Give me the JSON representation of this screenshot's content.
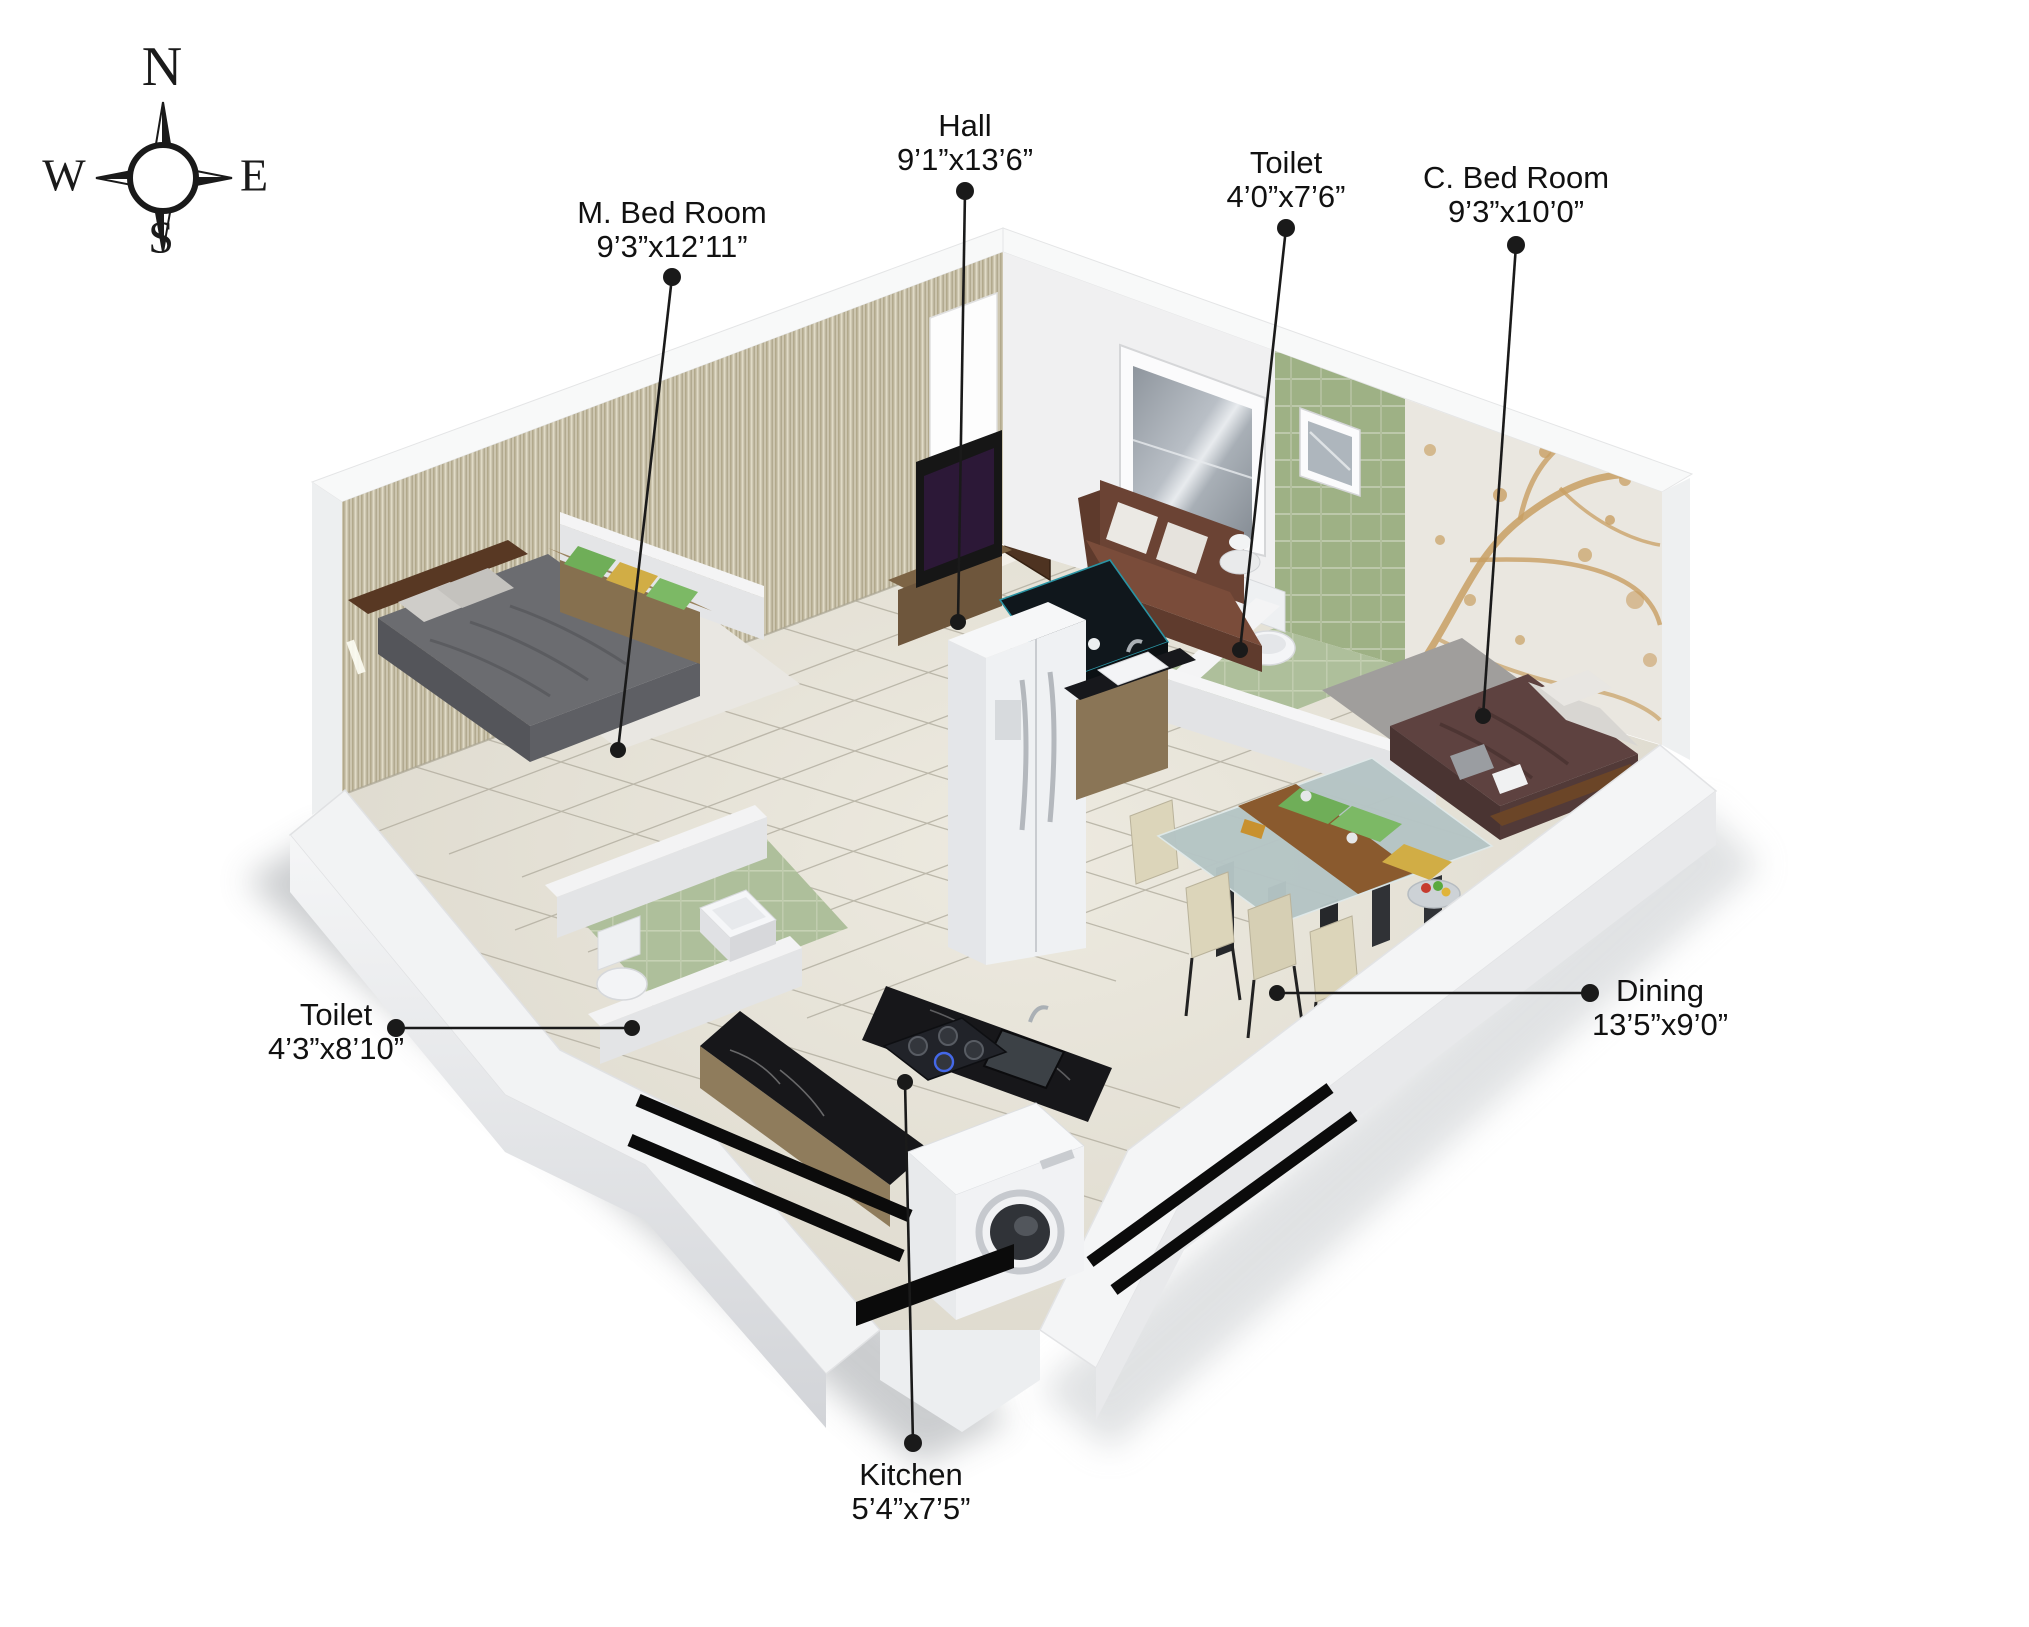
{
  "compass": {
    "n": "N",
    "e": "E",
    "s": "S",
    "w": "W"
  },
  "labels": {
    "m_bed_room": {
      "name": "M. Bed Room",
      "size": "9’3”x12’11”"
    },
    "hall": {
      "name": "Hall",
      "size": "9’1”x13’6”"
    },
    "toilet_attached": {
      "name": "Toilet",
      "size": "4’0”x7’6”"
    },
    "c_bed_room": {
      "name": "C. Bed Room",
      "size": "9’3”x10’0”"
    },
    "toilet_common": {
      "name": "Toilet",
      "size": "4’3”x8’10”"
    },
    "dining": {
      "name": "Dining",
      "size": "13’5”x9’0”"
    },
    "kitchen": {
      "name": "Kitchen",
      "size": "5’4”x7’5”"
    }
  },
  "colors": {
    "leader_line": "#1a1a1a",
    "label_text": "#111111",
    "wall_white": "#f4f5f6",
    "stripe_wallpaper": "#cdc6b0",
    "green_tile_wall": "#9fb287",
    "tree_branch_wallpaper": "#c89f63",
    "floor_tile": "#dcd8cc",
    "bathroom_floor": "#aebf9b",
    "kitchen_counter": "#17171a",
    "sofa_brown": "#6b4334",
    "master_bed_gray": "#6b6c70",
    "child_bed_maroon": "#5e4240",
    "dining_glass": "#b5c5c5",
    "door_brown": "#4e3321"
  }
}
